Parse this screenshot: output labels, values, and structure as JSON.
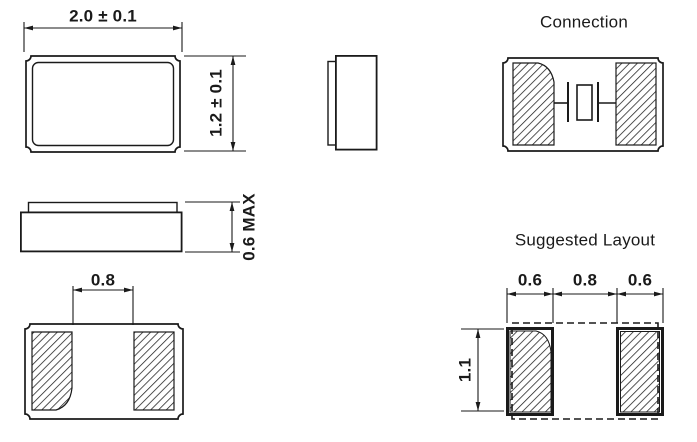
{
  "drawing": {
    "background": "#ffffff",
    "line_color": "#1a1a1a",
    "top_view": {
      "width_dim": "2.0 ± 0.1",
      "height_dim": "1.2 ± 0.1"
    },
    "side_view": {
      "height_dim": "0.6 MAX"
    },
    "bottom_view": {
      "pad_gap_dim": "0.8"
    },
    "connection_view": {
      "title": "Connection"
    },
    "layout_view": {
      "title": "Suggested Layout",
      "left_pad_width_dim": "0.6",
      "pad_gap_dim": "0.8",
      "right_pad_width_dim": "0.6",
      "pad_height_dim": "1.1"
    }
  }
}
